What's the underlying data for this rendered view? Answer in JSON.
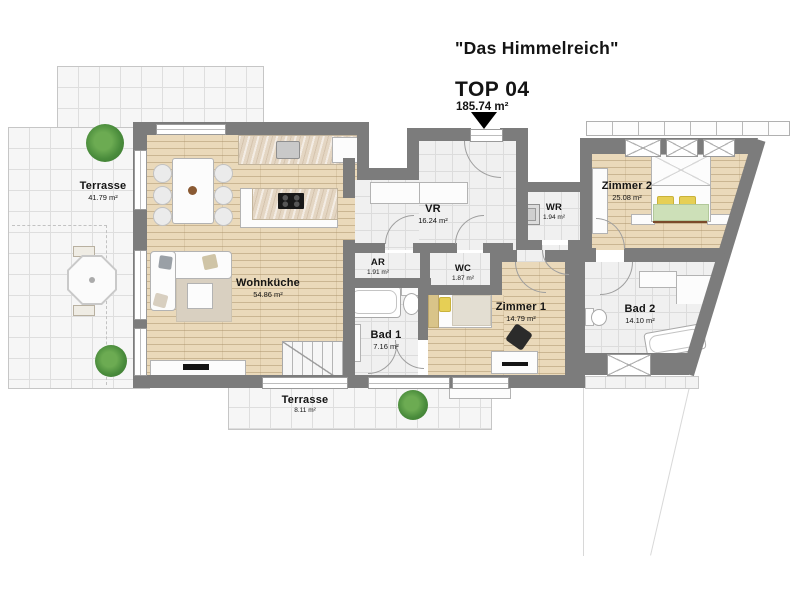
{
  "header": {
    "title": "\"Das Himmelreich\"",
    "unit": "TOP 04",
    "total_area": "185.74 m²"
  },
  "rooms": {
    "terrasse_links": {
      "name": "Terrasse",
      "area": "41.79 m²"
    },
    "wohnkueche": {
      "name": "Wohnküche",
      "area": "54.86 m²"
    },
    "vr": {
      "name": "VR",
      "area": "16.24 m²"
    },
    "ar": {
      "name": "AR",
      "area": "1.91 m²"
    },
    "wc": {
      "name": "WC",
      "area": "1.87 m²"
    },
    "wr": {
      "name": "WR",
      "area": "1.94 m²"
    },
    "zimmer1": {
      "name": "Zimmer 1",
      "area": "14.79 m²"
    },
    "zimmer2": {
      "name": "Zimmer 2",
      "area": "25.08 m²"
    },
    "bad1": {
      "name": "Bad 1",
      "area": "7.16 m²"
    },
    "bad2": {
      "name": "Bad 2",
      "area": "14.10 m²"
    },
    "terrasse_unten": {
      "name": "Terrasse",
      "area": "8.11 m²"
    }
  },
  "colors": {
    "wall": "#7c7c7c",
    "wood": "#ead9ba",
    "tile": "#f0f0f0",
    "plant": "#4a8c3c",
    "accent_pillow": "#e6cf55",
    "text": "#141414"
  }
}
